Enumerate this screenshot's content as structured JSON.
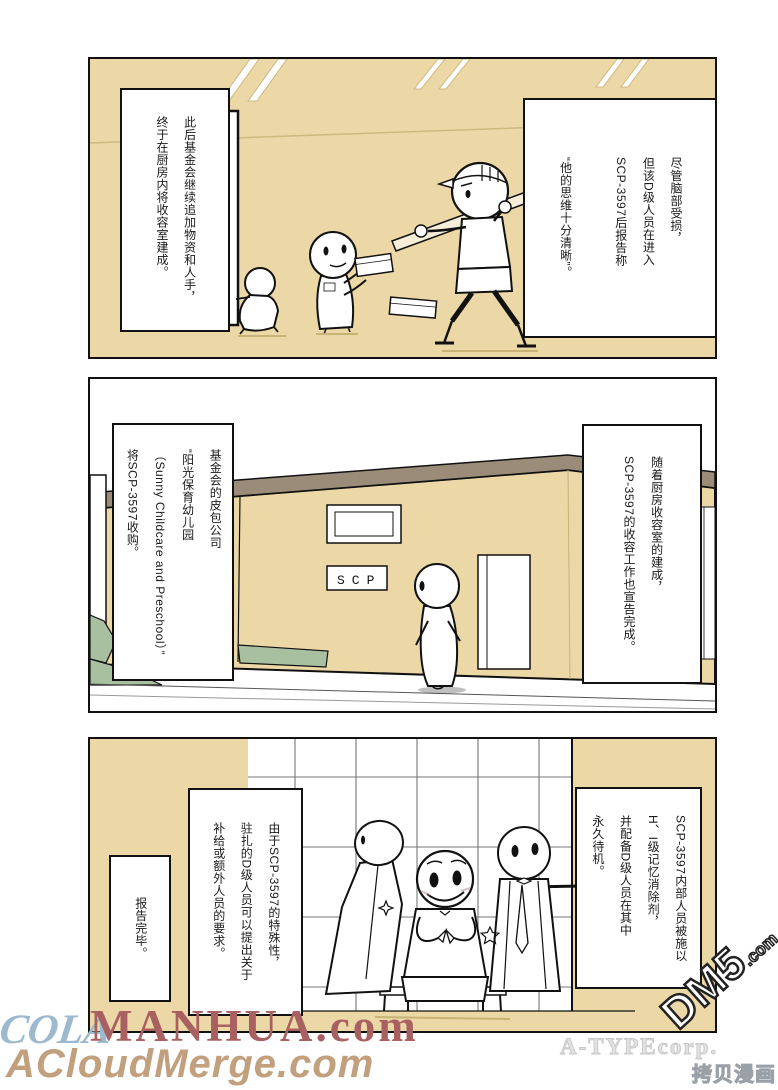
{
  "comic": {
    "panel1": {
      "narration_left": "此后基金会继续追加物资和人手，\n终于在厨房内将收容室建成。",
      "narration_right": "尽管脑部受损，\n但该D级人员在进入\nSCP-3597后报告称\n\n“他的思维十分清晰”。"
    },
    "panel2": {
      "narration_left": "基金会的皮包公司\n“阳光保育幼儿园\n（Sunny Childcare and Preschool）”\n将SCP-3597收购。",
      "narration_right": "随着厨房收容室的建成，\nSCP-3597的收容工作也宣告完成。",
      "sign_text": "SCP"
    },
    "panel3": {
      "narration_right": "SCP-3597内部人员被施以\nH、I级记忆消除剂，\n并配备D级人员在其中\n永久待机。",
      "narration_mid": "由于SCP-3597的特殊性，\n驻扎的D级人员可以提出关于\n补给或额外人员的要求。",
      "narration_small": "报告完毕。"
    }
  },
  "watermarks": {
    "cola": "COLA",
    "manhua": "MANHUA.com",
    "acloudmerge": "ACloudMerge.com",
    "atype": "A-TYPEcorp.",
    "dm5": "DM5",
    "dm5_suffix": ".com",
    "kaobei": "拷贝漫画"
  },
  "colors": {
    "wall_tan": "#ecd8a6",
    "roof_brown": "#9a8c78",
    "bush_green": "#a9c0a0",
    "ink": "#111111",
    "watermark_blue": "#9cb9d0",
    "watermark_red": "#a96060",
    "watermark_tan": "#c2a07e"
  }
}
